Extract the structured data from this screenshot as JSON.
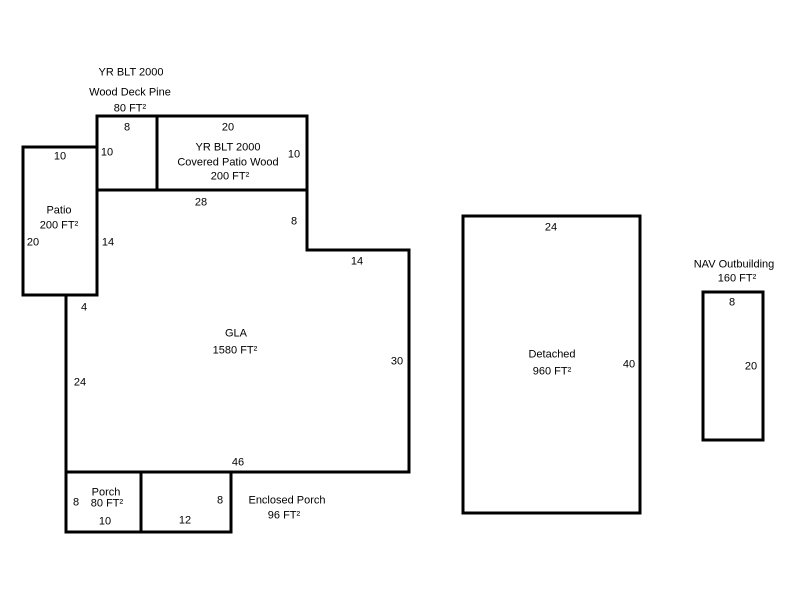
{
  "colors": {
    "line": "#000000",
    "background": "#ffffff",
    "text": "#000000"
  },
  "sketch": {
    "wood_deck": {
      "year_built": "YR BLT 2000",
      "name": "Wood Deck Pine",
      "area": "80 FT²",
      "dim_width": "8",
      "dim_height": "10"
    },
    "covered_patio": {
      "year_built": "YR BLT 2000",
      "name": "Covered Patio Wood",
      "area": "200 FT²",
      "dim_width": "20",
      "dim_height": "10"
    },
    "patio": {
      "name": "Patio",
      "area": "200 FT²",
      "dim_width": "10",
      "dim_height": "20"
    },
    "gla": {
      "name": "GLA",
      "area": "1580 FT²",
      "dims": {
        "top": "28",
        "upper_left": "14",
        "step_down": "8",
        "step_right": "14",
        "right": "30",
        "bottom": "46",
        "left": "24",
        "notch": "4"
      }
    },
    "porch": {
      "name": "Porch",
      "area": "80 FT²",
      "dim_height": "8",
      "dim_width": "10"
    },
    "enclosed_porch": {
      "name": "Enclosed Porch",
      "area": "96 FT²",
      "dim_height": "8",
      "dim_width": "12"
    },
    "detached": {
      "name": "Detached",
      "area": "960 FT²",
      "dim_width": "24",
      "dim_height": "40"
    },
    "outbuilding": {
      "name": "NAV Outbuilding",
      "area": "160 FT²",
      "dim_width": "8",
      "dim_height": "20"
    }
  }
}
